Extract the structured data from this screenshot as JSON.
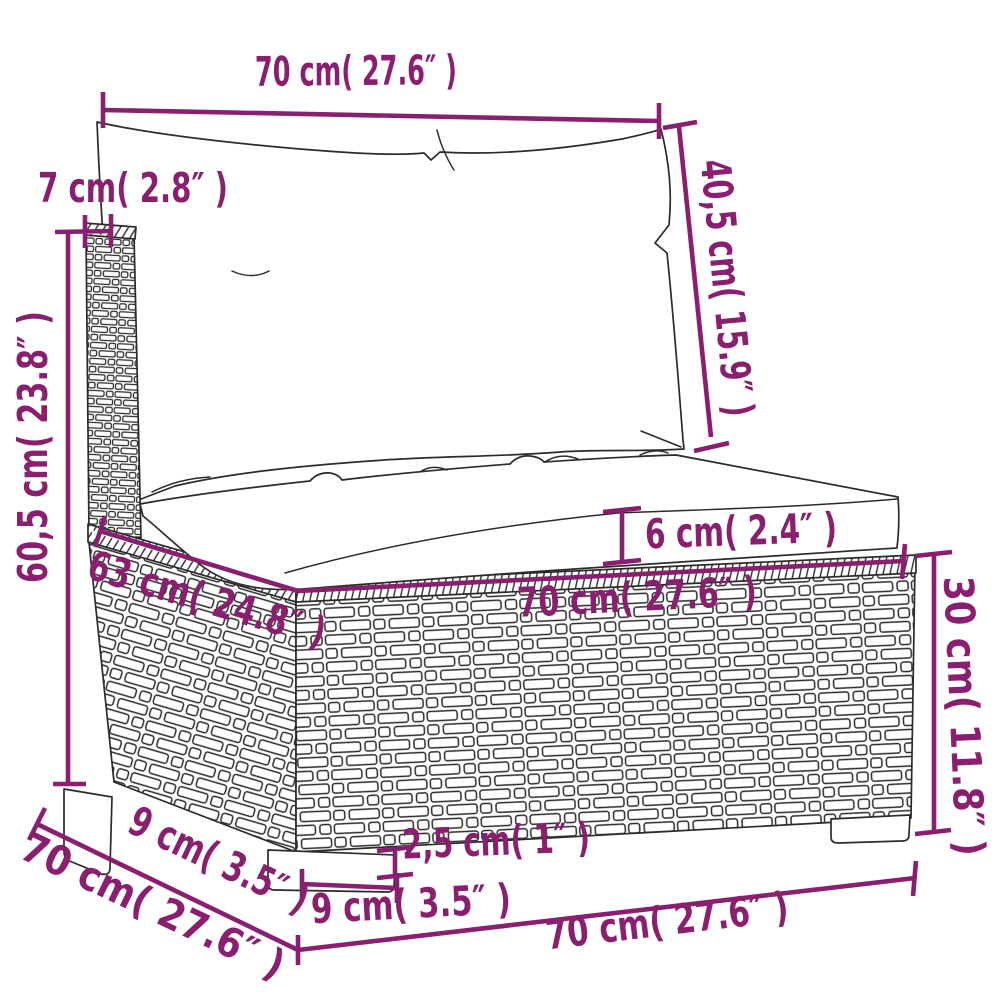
{
  "diagram": {
    "accent_color": "#8b1f6f",
    "line_color": "#2b2b2b",
    "dims": {
      "back_width": "70 cm( 27.6″ )",
      "post_width": "7 cm( 2.8″ )",
      "back_height": "40,5 cm( 15.9″ )",
      "total_height": "60,5 cm( 23.8″ )",
      "cushion_thickness": "6 cm( 2.4″ )",
      "seat_depth": "63 cm( 24.8″ )",
      "seat_width": "70 cm( 27.6″ )",
      "base_height": "30 cm( 11.8″ )",
      "leg_depth": "9 cm( 3.5″ )",
      "total_depth": "70 cm( 27.6″ )",
      "leg_height": "2,5 cm( 1″ )",
      "leg_width": "9 cm( 3.5″ )",
      "base_width": "70 cm( 27.6″ )"
    }
  }
}
